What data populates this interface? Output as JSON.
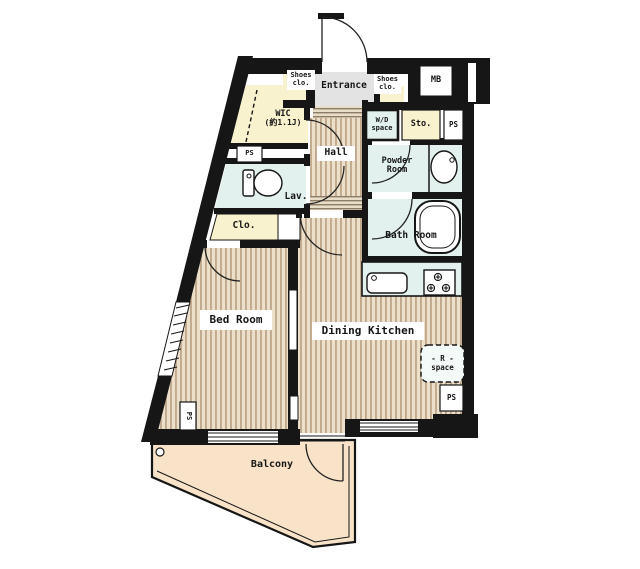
{
  "title": "apartment-floor-plan",
  "labels": {
    "entrance": "Entrance",
    "shoes_closet_line1": "Shoes",
    "shoes_closet_line2": "clo.",
    "meter_box": "MB",
    "wic_line1": "WIC",
    "wic_line2": "(約1.1J)",
    "pipe_space": "PS",
    "wd_line1": "W/D",
    "wd_line2": "space",
    "storage": "Sto.",
    "hall": "Hall",
    "powder_line1": "Powder",
    "powder_line2": "Room",
    "lavatory": "Lav.",
    "closet": "Clo.",
    "bathroom": "Bath Room",
    "bedroom": "Bed Room",
    "dining_kitchen": "Dining Kitchen",
    "fridge_line1": "- R -",
    "fridge_line2": "space",
    "balcony": "Balcony"
  },
  "colors": {
    "wall": "#161616",
    "wood_floor_base": "#ece0ca",
    "wood_floor_stripe": "#c0a98c",
    "wet_area": "#e2f1ee",
    "closet_yellow": "#f9f2cf",
    "balcony_floor": "#f8e3c8",
    "entrance_gray": "#e3e3e3",
    "label_background": "#ffffff"
  }
}
